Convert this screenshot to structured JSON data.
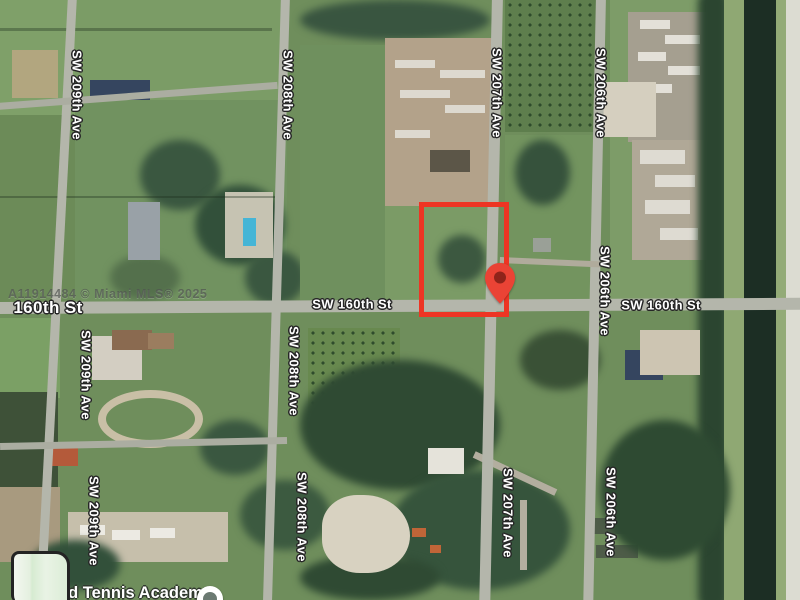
{
  "map": {
    "watermark": "A11914484 © Miami MLS® 2025",
    "street_labels": [
      {
        "name": "street-label-sw-209th-ave-top",
        "text": "SW 209th Ave",
        "x": 77,
        "y": 95,
        "vertical": true
      },
      {
        "name": "street-label-sw-208th-ave-top",
        "text": "SW 208th Ave",
        "x": 288,
        "y": 95,
        "vertical": true
      },
      {
        "name": "street-label-sw-207th-ave-top",
        "text": "SW 207th Ave",
        "x": 497,
        "y": 93,
        "vertical": true
      },
      {
        "name": "street-label-sw-206th-ave-top",
        "text": "SW 206th Ave",
        "x": 601,
        "y": 93,
        "vertical": true
      },
      {
        "name": "street-label-sw-206th-ave-mid",
        "text": "SW 206th Ave",
        "x": 605,
        "y": 291,
        "vertical": true
      },
      {
        "name": "street-label-sw-209th-ave-mid",
        "text": "SW 209th Ave",
        "x": 86,
        "y": 375,
        "vertical": true
      },
      {
        "name": "street-label-sw-208th-ave-mid",
        "text": "SW 208th Ave",
        "x": 294,
        "y": 371,
        "vertical": true
      },
      {
        "name": "street-label-sw-209th-ave-bottom",
        "text": "SW 209th Ave",
        "x": 94,
        "y": 521,
        "vertical": true
      },
      {
        "name": "street-label-sw-208th-ave-bottom",
        "text": "SW 208th Ave",
        "x": 302,
        "y": 517,
        "vertical": true
      },
      {
        "name": "street-label-sw-207th-ave-bottom",
        "text": "SW 207th Ave",
        "x": 508,
        "y": 513,
        "vertical": true
      },
      {
        "name": "street-label-sw-206th-ave-bottom",
        "text": "SW 206th Ave",
        "x": 611,
        "y": 512,
        "vertical": true
      },
      {
        "name": "street-label-160th-st-left",
        "text": "160th St",
        "x": 48,
        "y": 308,
        "vertical": false,
        "size": "lg"
      },
      {
        "name": "street-label-sw-160th-st-center",
        "text": "SW 160th St",
        "x": 352,
        "y": 304,
        "vertical": false
      },
      {
        "name": "street-label-sw-160th-st-right",
        "text": "SW 160th St",
        "x": 661,
        "y": 305,
        "vertical": false
      }
    ],
    "parcel_outline": {
      "x": 419,
      "y": 202,
      "width": 80,
      "height": 105,
      "color": "#ee3524"
    },
    "pin": {
      "x": 500,
      "y": 305,
      "color": "#ea4335",
      "hole_color": "#8f231a"
    },
    "poi": {
      "label": "nd Tennis Academy"
    }
  }
}
